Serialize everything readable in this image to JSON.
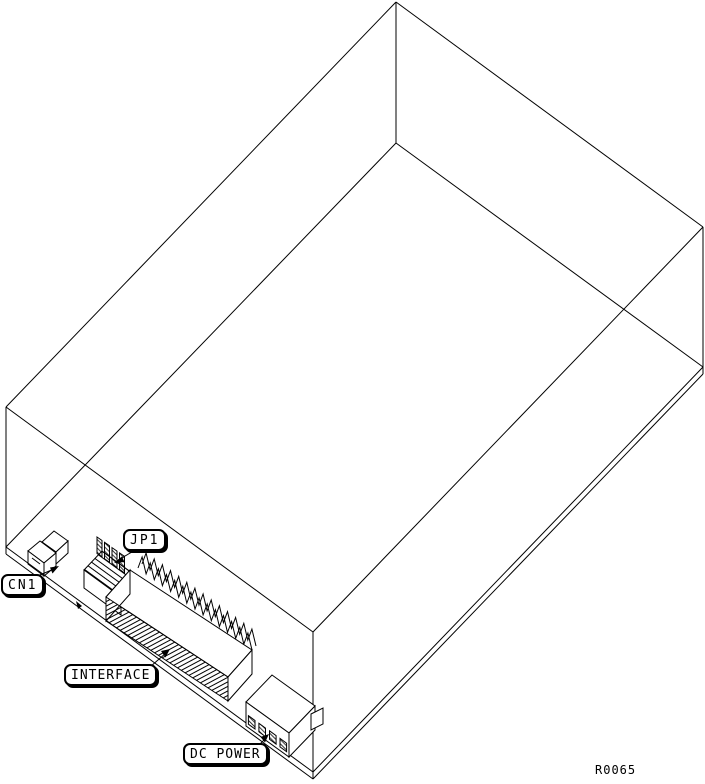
{
  "drawing": {
    "callouts": {
      "cn1": "CN1",
      "jp1": "JP1",
      "interface": "INTERFACE",
      "dc_power": "DC POWER"
    },
    "reference_number": "R0065",
    "colors": {
      "line": "#000000",
      "background": "#ffffff"
    }
  }
}
